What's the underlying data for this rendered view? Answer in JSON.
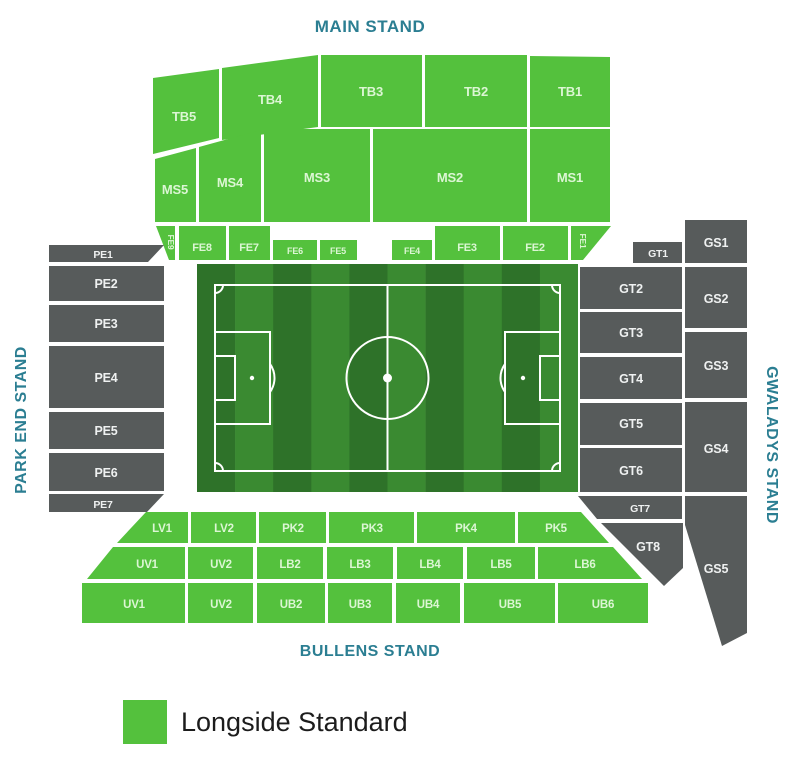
{
  "stands": {
    "top": "MAIN STAND",
    "bottom": "BULLENS STAND",
    "left": "PARK END STAND",
    "right": "GWALADYS STAND"
  },
  "legend": {
    "items": [
      {
        "label": "Longside Standard",
        "color": "#54c13d"
      }
    ]
  },
  "colors": {
    "green": "#54c13d",
    "grey": "#575b5b",
    "stand_title": "#2b7e92",
    "label_on_green": "#dcf6d4",
    "label_on_grey": "#eff1f1",
    "pitch_dark": "#2e7229",
    "pitch_light": "#3a8a31",
    "pitch_line": "#ffffff",
    "legend_text": "#1c1c1c"
  },
  "sections": [
    {
      "id": "tb5",
      "label": "TB5",
      "color": "green",
      "points": "153,78 219,69 219,138 153,154",
      "label_x": 184,
      "label_y": 121,
      "font_size": 13
    },
    {
      "id": "tb4",
      "label": "TB4",
      "color": "green",
      "points": "222,68 318,55 318,127 222,140",
      "label_x": 270,
      "label_y": 104,
      "font_size": 13
    },
    {
      "id": "tb3",
      "label": "TB3",
      "color": "green",
      "points": "321,55 422,55 422,127 321,127",
      "label_x": 371,
      "label_y": 96,
      "font_size": 13
    },
    {
      "id": "tb2",
      "label": "TB2",
      "color": "green",
      "points": "425,55 527,55 527,127 425,127",
      "label_x": 476,
      "label_y": 96,
      "font_size": 13
    },
    {
      "id": "tb1",
      "label": "TB1",
      "color": "green",
      "points": "530,56 610,57 610,127 530,127",
      "label_x": 570,
      "label_y": 96,
      "font_size": 13
    },
    {
      "id": "ms5",
      "label": "MS5",
      "color": "green",
      "points": "155,159 196,148 196,222 155,222",
      "label_x": 175,
      "label_y": 194,
      "font_size": 13
    },
    {
      "id": "ms4",
      "label": "MS4",
      "color": "green",
      "points": "199,147 261,130 261,222 199,222",
      "label_x": 230,
      "label_y": 187,
      "font_size": 13
    },
    {
      "id": "ms3",
      "label": "MS3",
      "color": "green",
      "points": "264,129 370,129 370,222 264,222",
      "label_x": 317,
      "label_y": 182,
      "font_size": 13
    },
    {
      "id": "ms2",
      "label": "MS2",
      "color": "green",
      "points": "373,129 527,129 527,222 373,222",
      "label_x": 450,
      "label_y": 182,
      "font_size": 13
    },
    {
      "id": "ms1",
      "label": "MS1",
      "color": "green",
      "points": "530,129 610,129 610,222 530,222",
      "label_x": 570,
      "label_y": 182,
      "font_size": 13
    },
    {
      "id": "fe9",
      "label": "FE9",
      "color": "green",
      "points": "156,226 175,226 175,260 169,260",
      "label_x": 168,
      "label_y": 242,
      "font_size": 8.5,
      "rotate": 90
    },
    {
      "id": "fe8",
      "label": "FE8",
      "color": "green",
      "points": "179,226 226,226 226,260 179,260",
      "label_x": 202,
      "label_y": 251,
      "font_size": 11
    },
    {
      "id": "fe7",
      "label": "FE7",
      "color": "green",
      "points": "229,226 270,226 270,260 229,260",
      "label_x": 249,
      "label_y": 251,
      "font_size": 11
    },
    {
      "id": "fe6",
      "label": "FE6",
      "color": "green",
      "points": "273,240 317,240 317,260 273,260",
      "label_x": 295,
      "label_y": 254,
      "font_size": 9
    },
    {
      "id": "fe5",
      "label": "FE5",
      "color": "green",
      "points": "320,240 357,240 357,260 320,260",
      "label_x": 338,
      "label_y": 254,
      "font_size": 9
    },
    {
      "id": "fe4",
      "label": "FE4",
      "color": "green",
      "points": "392,240 432,240 432,260 392,260",
      "label_x": 412,
      "label_y": 254,
      "font_size": 9
    },
    {
      "id": "fe3",
      "label": "FE3",
      "color": "green",
      "points": "435,226 500,226 500,260 435,260",
      "label_x": 467,
      "label_y": 251,
      "font_size": 11
    },
    {
      "id": "fe2",
      "label": "FE2",
      "color": "green",
      "points": "503,226 568,226 568,260 503,260",
      "label_x": 535,
      "label_y": 251,
      "font_size": 11
    },
    {
      "id": "fe1",
      "label": "FE1",
      "color": "green",
      "points": "571,226 611,226 583,260 571,260",
      "label_x": 580,
      "label_y": 241,
      "font_size": 8.5,
      "rotate": 90
    },
    {
      "id": "pe1",
      "label": "PE1",
      "color": "grey",
      "points": "49,245 164,245 148,262 49,262",
      "label_x": 103,
      "label_y": 258,
      "font_size": 10.5
    },
    {
      "id": "pe2",
      "label": "PE2",
      "color": "grey",
      "points": "49,266 164,266 164,301 49,301",
      "label_x": 106,
      "label_y": 288,
      "font_size": 12.5
    },
    {
      "id": "pe3",
      "label": "PE3",
      "color": "grey",
      "points": "49,305 164,305 164,342 49,342",
      "label_x": 106,
      "label_y": 328,
      "font_size": 12.5
    },
    {
      "id": "pe4",
      "label": "PE4",
      "color": "grey",
      "points": "49,346 164,346 164,408 49,408",
      "label_x": 106,
      "label_y": 382,
      "font_size": 12.5
    },
    {
      "id": "pe5",
      "label": "PE5",
      "color": "grey",
      "points": "49,412 164,412 164,449 49,449",
      "label_x": 106,
      "label_y": 435,
      "font_size": 12.5
    },
    {
      "id": "pe6",
      "label": "PE6",
      "color": "grey",
      "points": "49,453 164,453 164,491 49,491",
      "label_x": 106,
      "label_y": 477,
      "font_size": 12.5
    },
    {
      "id": "pe7",
      "label": "PE7",
      "color": "grey",
      "points": "49,494 164,494 147,512 49,512",
      "label_x": 103,
      "label_y": 508,
      "font_size": 10.5
    },
    {
      "id": "gt1",
      "label": "GT1",
      "color": "grey",
      "points": "633,242 682,242 682,263 633,263",
      "label_x": 658,
      "label_y": 257,
      "font_size": 10.5
    },
    {
      "id": "gt2",
      "label": "GT2",
      "color": "grey",
      "points": "580,267 682,267 682,309 580,309",
      "label_x": 631,
      "label_y": 293,
      "font_size": 12.5
    },
    {
      "id": "gt3",
      "label": "GT3",
      "color": "grey",
      "points": "580,312 682,312 682,353 580,353",
      "label_x": 631,
      "label_y": 337,
      "font_size": 12.5
    },
    {
      "id": "gt4",
      "label": "GT4",
      "color": "grey",
      "points": "580,357 682,357 682,399 580,399",
      "label_x": 631,
      "label_y": 383,
      "font_size": 12.5
    },
    {
      "id": "gt5",
      "label": "GT5",
      "color": "grey",
      "points": "580,403 682,403 682,445 580,445",
      "label_x": 631,
      "label_y": 428,
      "font_size": 12.5
    },
    {
      "id": "gt6",
      "label": "GT6",
      "color": "grey",
      "points": "580,448 682,448 682,492 580,492",
      "label_x": 631,
      "label_y": 475,
      "font_size": 12.5
    },
    {
      "id": "gt7",
      "label": "GT7",
      "color": "grey",
      "points": "578,496 682,496 682,519 597,519",
      "label_x": 640,
      "label_y": 512,
      "font_size": 10.5
    },
    {
      "id": "gt8",
      "label": "GT8",
      "color": "grey",
      "points": "601,523 683,523 683,568 664,586",
      "label_x": 648,
      "label_y": 551,
      "font_size": 12.5
    },
    {
      "id": "gs1",
      "label": "GS1",
      "color": "grey",
      "points": "685,220 747,220 747,263 685,263",
      "label_x": 716,
      "label_y": 247,
      "font_size": 12.5
    },
    {
      "id": "gs2",
      "label": "GS2",
      "color": "grey",
      "points": "685,267 747,267 747,328 685,328",
      "label_x": 716,
      "label_y": 303,
      "font_size": 12.5
    },
    {
      "id": "gs3",
      "label": "GS3",
      "color": "grey",
      "points": "685,332 747,332 747,398 685,398",
      "label_x": 716,
      "label_y": 370,
      "font_size": 12.5
    },
    {
      "id": "gs4",
      "label": "GS4",
      "color": "grey",
      "points": "685,402 747,402 747,492 685,492",
      "label_x": 716,
      "label_y": 453,
      "font_size": 12.5
    },
    {
      "id": "gs5",
      "label": "GS5",
      "color": "grey",
      "points": "685,496 747,496 747,633 722,646 685,525",
      "label_x": 716,
      "label_y": 573,
      "font_size": 12.5
    },
    {
      "id": "lv1",
      "label": "LV1",
      "color": "green",
      "points": "146,512 188,512 188,543 117,543",
      "label_x": 162,
      "label_y": 532,
      "font_size": 11.5
    },
    {
      "id": "lv2",
      "label": "LV2",
      "color": "green",
      "points": "191,512 256,512 256,543 191,543",
      "label_x": 224,
      "label_y": 532,
      "font_size": 11.5
    },
    {
      "id": "pk2",
      "label": "PK2",
      "color": "green",
      "points": "259,512 326,512 326,543 259,543",
      "label_x": 293,
      "label_y": 532,
      "font_size": 11.5
    },
    {
      "id": "pk3",
      "label": "PK3",
      "color": "green",
      "points": "329,512 414,512 414,543 329,543",
      "label_x": 372,
      "label_y": 532,
      "font_size": 11.5
    },
    {
      "id": "pk4",
      "label": "PK4",
      "color": "green",
      "points": "417,512 515,512 515,543 417,543",
      "label_x": 466,
      "label_y": 532,
      "font_size": 11.5
    },
    {
      "id": "pk5",
      "label": "PK5",
      "color": "green",
      "points": "518,512 581,512 609,543 518,543",
      "label_x": 556,
      "label_y": 532,
      "font_size": 11.5
    },
    {
      "id": "uv1-upper",
      "label": "UV1",
      "color": "green",
      "points": "113,547 185,547 185,579 87,579",
      "label_x": 147,
      "label_y": 568,
      "font_size": 11.5
    },
    {
      "id": "uv2-upper",
      "label": "UV2",
      "color": "green",
      "points": "188,547 253,547 253,579 188,579",
      "label_x": 221,
      "label_y": 568,
      "font_size": 11.5
    },
    {
      "id": "lb2",
      "label": "LB2",
      "color": "green",
      "points": "257,547 323,547 323,579 257,579",
      "label_x": 290,
      "label_y": 568,
      "font_size": 11.5
    },
    {
      "id": "lb3",
      "label": "LB3",
      "color": "green",
      "points": "327,547 393,547 393,579 327,579",
      "label_x": 360,
      "label_y": 568,
      "font_size": 11.5
    },
    {
      "id": "lb4",
      "label": "LB4",
      "color": "green",
      "points": "397,547 463,547 463,579 397,579",
      "label_x": 430,
      "label_y": 568,
      "font_size": 11.5
    },
    {
      "id": "lb5",
      "label": "LB5",
      "color": "green",
      "points": "467,547 535,547 535,579 467,579",
      "label_x": 501,
      "label_y": 568,
      "font_size": 11.5
    },
    {
      "id": "lb6",
      "label": "LB6",
      "color": "green",
      "points": "538,547 613,547 642,579 538,579",
      "label_x": 585,
      "label_y": 568,
      "font_size": 11.5
    },
    {
      "id": "uv1-lower",
      "label": "UV1",
      "color": "green",
      "points": "82,583 185,583 185,623 82,623",
      "label_x": 134,
      "label_y": 608,
      "font_size": 11.5
    },
    {
      "id": "uv2-lower",
      "label": "UV2",
      "color": "green",
      "points": "188,583 253,583 253,623 188,623",
      "label_x": 221,
      "label_y": 608,
      "font_size": 11.5
    },
    {
      "id": "ub2",
      "label": "UB2",
      "color": "green",
      "points": "257,583 325,583 325,623 257,623",
      "label_x": 291,
      "label_y": 608,
      "font_size": 11.5
    },
    {
      "id": "ub3",
      "label": "UB3",
      "color": "green",
      "points": "328,583 392,583 392,623 328,623",
      "label_x": 360,
      "label_y": 608,
      "font_size": 11.5
    },
    {
      "id": "ub4",
      "label": "UB4",
      "color": "green",
      "points": "396,583 460,583 460,623 396,623",
      "label_x": 428,
      "label_y": 608,
      "font_size": 11.5
    },
    {
      "id": "ub5",
      "label": "UB5",
      "color": "green",
      "points": "464,583 555,583 555,623 464,623",
      "label_x": 510,
      "label_y": 608,
      "font_size": 11.5
    },
    {
      "id": "ub6",
      "label": "UB6",
      "color": "green",
      "points": "558,583 648,583 648,623 558,623",
      "label_x": 603,
      "label_y": 608,
      "font_size": 11.5
    }
  ]
}
